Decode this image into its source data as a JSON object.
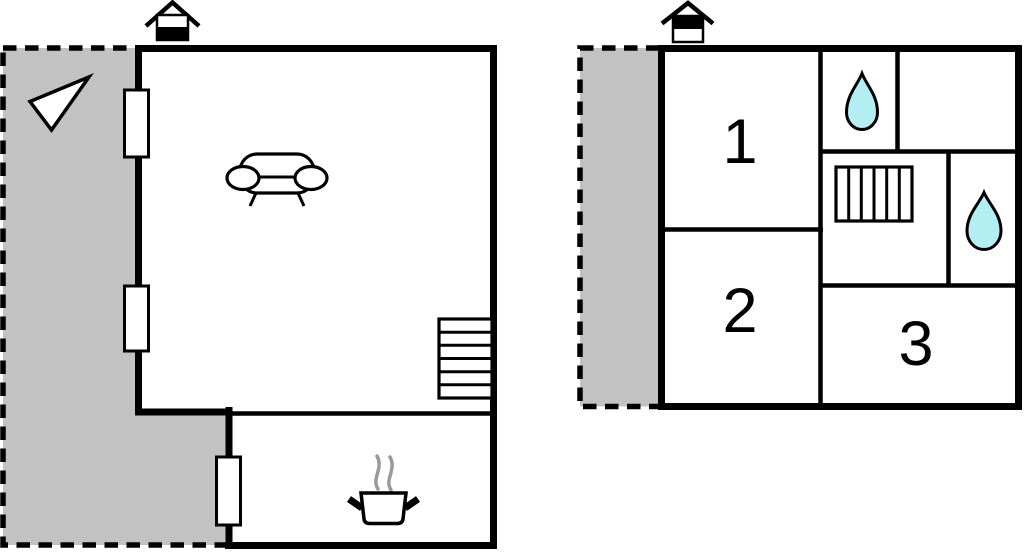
{
  "colors": {
    "background": "#ffffff",
    "wall": "#000000",
    "terrace_fill": "#c2c2c2",
    "water_drop_fill": "#b2eef2",
    "steam_gray": "#9a9a9a"
  },
  "ground_floor": {
    "icons": [
      "chimney-icon",
      "north-arrow-icon",
      "sofa-icon",
      "stairs-icon",
      "cooking-pot-icon"
    ],
    "window_count": 3
  },
  "upper_floor": {
    "rooms": [
      {
        "label": "1"
      },
      {
        "label": "2"
      },
      {
        "label": "3"
      }
    ],
    "icons": [
      "chimney-icon",
      "water-drop-icon",
      "water-drop-icon",
      "stairs-icon"
    ]
  }
}
